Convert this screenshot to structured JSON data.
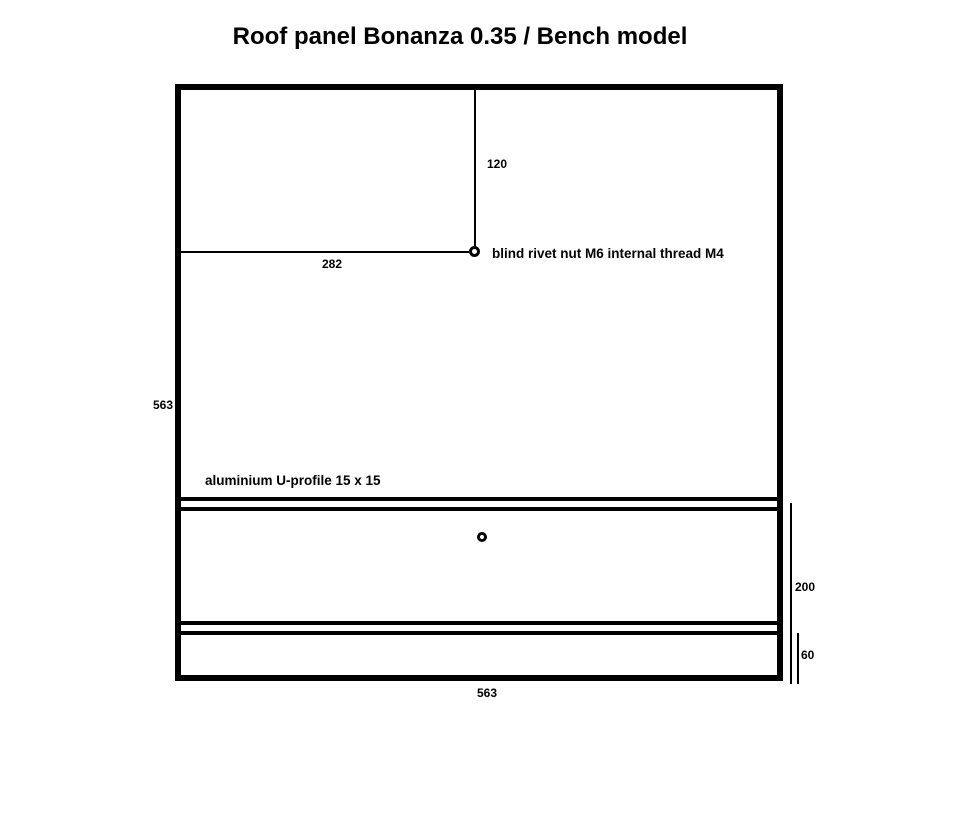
{
  "title": "Roof panel Bonanza 0.35 / Bench model",
  "colors": {
    "ink": "#000000",
    "paper": "#ffffff"
  },
  "drawing": {
    "annotations": {
      "rivet_nut_label": "blind rivet nut M6 internal thread M4",
      "u_profile_label": "aluminium U-profile 15 x 15"
    },
    "dimensions": {
      "panel_height": "563",
      "panel_width": "563",
      "rivet_from_left": "282",
      "rivet_from_top": "120",
      "bench_section": "200",
      "bottom_strip": "60"
    }
  }
}
